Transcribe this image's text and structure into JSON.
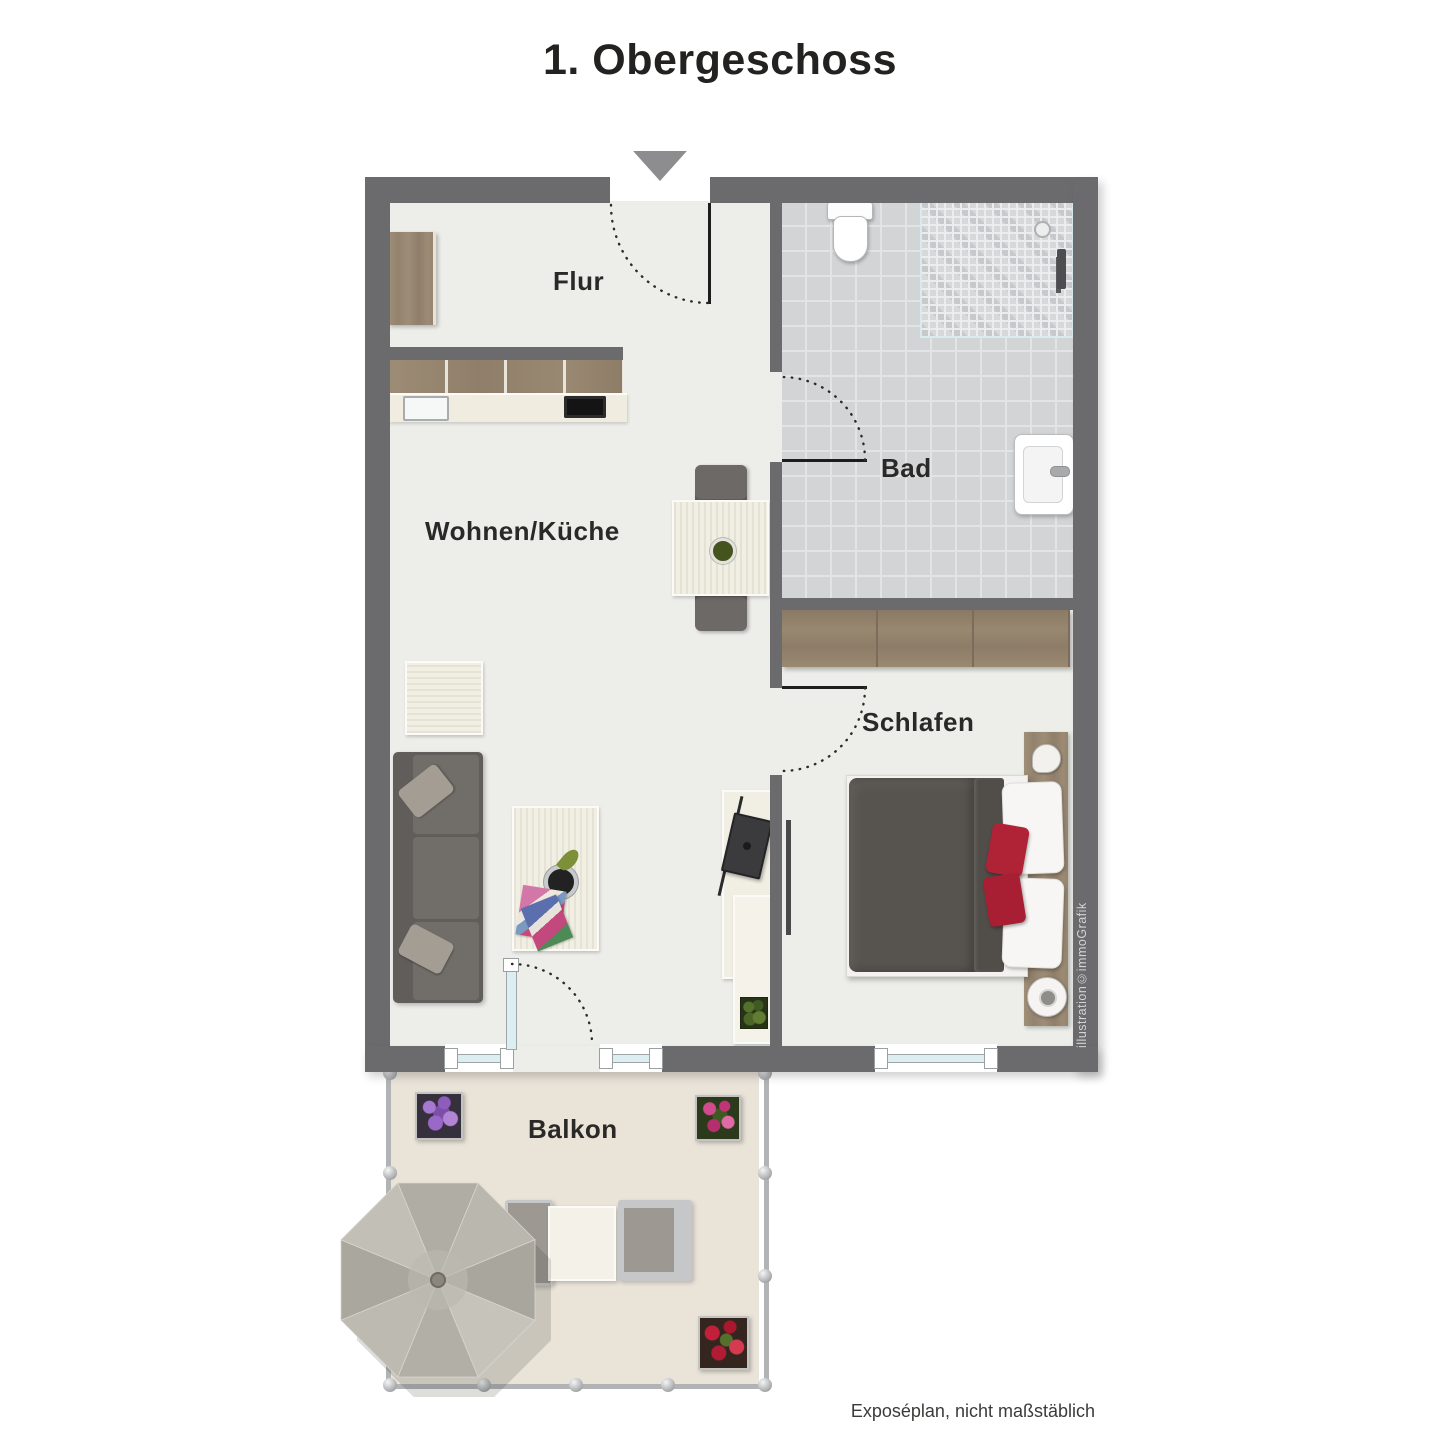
{
  "title": "1. Obergeschoss",
  "rooms": {
    "flur": "Flur",
    "wohnen_kueche": "Wohnen/Küche",
    "bad": "Bad",
    "schlafen": "Schlafen",
    "balkon": "Balkon"
  },
  "credit": "illustration©immoGrafik",
  "footer": "Exposéplan, nicht maßstäblich",
  "icons": {
    "entrance_arrow": "entrance-direction-arrow",
    "door_swings": [
      "entrance-door-swing",
      "bathroom-door-swing",
      "bedroom-door-swing",
      "balcony-door-swing"
    ]
  },
  "colors": {
    "wall": "#6b6b6d",
    "floor": "#edeeea",
    "bath_tile": "#d3d4d6",
    "balcony_floor": "#e9e3d8",
    "wood": "#998871",
    "accent_red": "#b02337",
    "umbrella": "#b9b6ad",
    "text": "#2a2927"
  }
}
